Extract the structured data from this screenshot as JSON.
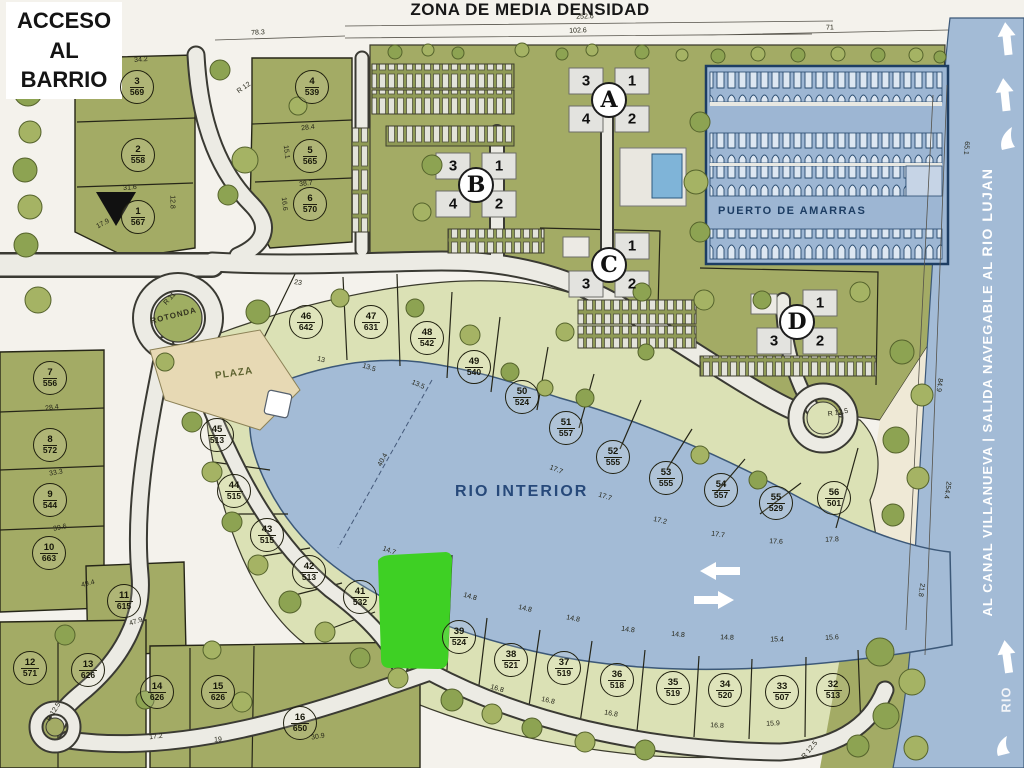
{
  "banner": "ZONA DE MEDIA DENSIDAD",
  "access_sign": {
    "l1": "ACCESO",
    "l2": "AL",
    "l3": "BARRIO"
  },
  "labels": {
    "rio_interior": "RIO INTERIOR",
    "puerto": "PUERTO DE AMARRAS",
    "plaza": "PLAZA",
    "rotonda": "ROTONDA",
    "canal_prefix": "AL CANAL VILLANUEVA  |  SALIDA NAVEGABLE AL ",
    "rio_lujan": "RIO LUJAN",
    "rio": "RIO"
  },
  "colors": {
    "paper": "#f4f2ec",
    "water": "#a3bbd6",
    "land": "#a3ab65",
    "lots": "#dbe1b5",
    "road": "#ecebe4",
    "marina": "#9db6d3",
    "highlight": "#3ed024",
    "navy": "#1d3d63"
  },
  "buildings": [
    {
      "letter": "A",
      "x": 609,
      "y": 100,
      "units": [
        {
          "n": "3",
          "dx": -23,
          "dy": -19
        },
        {
          "n": "1",
          "dx": 23,
          "dy": -19
        },
        {
          "n": "4",
          "dx": -23,
          "dy": 19
        },
        {
          "n": "2",
          "dx": 23,
          "dy": 19
        }
      ]
    },
    {
      "letter": "B",
      "x": 476,
      "y": 185,
      "units": [
        {
          "n": "3",
          "dx": -23,
          "dy": -19
        },
        {
          "n": "1",
          "dx": 23,
          "dy": -19
        },
        {
          "n": "4",
          "dx": -23,
          "dy": 19
        },
        {
          "n": "2",
          "dx": 23,
          "dy": 19
        }
      ]
    },
    {
      "letter": "C",
      "x": 609,
      "y": 265,
      "units": [
        {
          "n": "1",
          "dx": 23,
          "dy": -19
        },
        {
          "n": "2",
          "dx": 23,
          "dy": 19
        },
        {
          "n": "3",
          "dx": -23,
          "dy": 19
        }
      ]
    },
    {
      "letter": "D",
      "x": 797,
      "y": 322,
      "units": [
        {
          "n": "1",
          "dx": 23,
          "dy": -19
        },
        {
          "n": "2",
          "dx": 23,
          "dy": 19
        },
        {
          "n": "3",
          "dx": -23,
          "dy": 19
        }
      ]
    }
  ],
  "lots": [
    {
      "n": "1",
      "a": "567",
      "x": 138,
      "y": 217
    },
    {
      "n": "2",
      "a": "558",
      "x": 138,
      "y": 155
    },
    {
      "n": "3",
      "a": "569",
      "x": 137,
      "y": 87
    },
    {
      "n": "4",
      "a": "539",
      "x": 312,
      "y": 87
    },
    {
      "n": "5",
      "a": "565",
      "x": 310,
      "y": 156
    },
    {
      "n": "6",
      "a": "570",
      "x": 310,
      "y": 204
    },
    {
      "n": "7",
      "a": "556",
      "x": 50,
      "y": 378
    },
    {
      "n": "8",
      "a": "572",
      "x": 50,
      "y": 445
    },
    {
      "n": "9",
      "a": "544",
      "x": 50,
      "y": 500
    },
    {
      "n": "10",
      "a": "663",
      "x": 49,
      "y": 553
    },
    {
      "n": "11",
      "a": "615",
      "x": 124,
      "y": 601
    },
    {
      "n": "12",
      "a": "571",
      "x": 30,
      "y": 668
    },
    {
      "n": "13",
      "a": "626",
      "x": 88,
      "y": 670
    },
    {
      "n": "14",
      "a": "626",
      "x": 157,
      "y": 692
    },
    {
      "n": "15",
      "a": "626",
      "x": 218,
      "y": 692
    },
    {
      "n": "16",
      "a": "650",
      "x": 300,
      "y": 723
    },
    {
      "n": "32",
      "a": "513",
      "x": 833,
      "y": 690
    },
    {
      "n": "33",
      "a": "507",
      "x": 782,
      "y": 692
    },
    {
      "n": "34",
      "a": "520",
      "x": 725,
      "y": 690
    },
    {
      "n": "35",
      "a": "519",
      "x": 673,
      "y": 688
    },
    {
      "n": "36",
      "a": "518",
      "x": 617,
      "y": 680
    },
    {
      "n": "37",
      "a": "519",
      "x": 564,
      "y": 668
    },
    {
      "n": "38",
      "a": "521",
      "x": 511,
      "y": 660
    },
    {
      "n": "39",
      "a": "524",
      "x": 459,
      "y": 637
    },
    {
      "n": "41",
      "a": "532",
      "x": 360,
      "y": 597
    },
    {
      "n": "42",
      "a": "513",
      "x": 309,
      "y": 572
    },
    {
      "n": "43",
      "a": "515",
      "x": 267,
      "y": 535
    },
    {
      "n": "44",
      "a": "515",
      "x": 234,
      "y": 491
    },
    {
      "n": "45",
      "a": "513",
      "x": 217,
      "y": 435
    },
    {
      "n": "46",
      "a": "642",
      "x": 306,
      "y": 322
    },
    {
      "n": "47",
      "a": "631",
      "x": 371,
      "y": 322
    },
    {
      "n": "48",
      "a": "542",
      "x": 427,
      "y": 338
    },
    {
      "n": "49",
      "a": "540",
      "x": 474,
      "y": 367
    },
    {
      "n": "50",
      "a": "524",
      "x": 522,
      "y": 397
    },
    {
      "n": "51",
      "a": "557",
      "x": 566,
      "y": 428
    },
    {
      "n": "52",
      "a": "555",
      "x": 613,
      "y": 457
    },
    {
      "n": "53",
      "a": "555",
      "x": 666,
      "y": 478
    },
    {
      "n": "54",
      "a": "557",
      "x": 721,
      "y": 490
    },
    {
      "n": "55",
      "a": "529",
      "x": 776,
      "y": 503
    },
    {
      "n": "56",
      "a": "501",
      "x": 834,
      "y": 498
    }
  ],
  "dims": [
    {
      "t": "78.3",
      "x": 258,
      "y": 33,
      "r": -3
    },
    {
      "t": "252.6",
      "x": 585,
      "y": 17,
      "r": -2
    },
    {
      "t": "102.6",
      "x": 578,
      "y": 31,
      "r": -2
    },
    {
      "t": "71",
      "x": 830,
      "y": 28,
      "r": -2
    },
    {
      "t": "34.2",
      "x": 141,
      "y": 60,
      "r": -4
    },
    {
      "t": "31.6",
      "x": 130,
      "y": 188,
      "r": -4
    },
    {
      "t": "17.9",
      "x": 103,
      "y": 224,
      "r": -28
    },
    {
      "t": "12.8",
      "x": 172,
      "y": 202,
      "r": 90
    },
    {
      "t": "28.4",
      "x": 308,
      "y": 128,
      "r": -6
    },
    {
      "t": "38.7",
      "x": 306,
      "y": 184,
      "r": -6
    },
    {
      "t": "15.1",
      "x": 286,
      "y": 152,
      "r": 84
    },
    {
      "t": "16.6",
      "x": 284,
      "y": 204,
      "r": 84
    },
    {
      "t": "R 12",
      "x": 244,
      "y": 88,
      "r": -35
    },
    {
      "t": "R 11",
      "x": 170,
      "y": 299,
      "r": -48
    },
    {
      "t": "28.4",
      "x": 52,
      "y": 408,
      "r": -8
    },
    {
      "t": "33.3",
      "x": 56,
      "y": 473,
      "r": -10
    },
    {
      "t": "39.6",
      "x": 60,
      "y": 528,
      "r": -12
    },
    {
      "t": "49.4",
      "x": 88,
      "y": 584,
      "r": -14
    },
    {
      "t": "47.9",
      "x": 136,
      "y": 622,
      "r": -18
    },
    {
      "t": "R 12.5",
      "x": 54,
      "y": 712,
      "r": -58
    },
    {
      "t": "17.2",
      "x": 156,
      "y": 737,
      "r": -6
    },
    {
      "t": "19",
      "x": 218,
      "y": 740,
      "r": -4
    },
    {
      "t": "30.9",
      "x": 318,
      "y": 737,
      "r": -10
    },
    {
      "t": "23",
      "x": 298,
      "y": 283,
      "r": 8
    },
    {
      "t": "13",
      "x": 321,
      "y": 360,
      "r": 14
    },
    {
      "t": "13.5",
      "x": 369,
      "y": 368,
      "r": 18
    },
    {
      "t": "13.5",
      "x": 418,
      "y": 385,
      "r": 24
    },
    {
      "t": "40.4",
      "x": 383,
      "y": 460,
      "r": -62
    },
    {
      "t": "17.7",
      "x": 556,
      "y": 470,
      "r": 22
    },
    {
      "t": "17.7",
      "x": 605,
      "y": 497,
      "r": 18
    },
    {
      "t": "17.2",
      "x": 660,
      "y": 521,
      "r": 13
    },
    {
      "t": "17.7",
      "x": 718,
      "y": 535,
      "r": 8
    },
    {
      "t": "17.6",
      "x": 776,
      "y": 542,
      "r": 3
    },
    {
      "t": "17.8",
      "x": 832,
      "y": 540,
      "r": -2
    },
    {
      "t": "14.7",
      "x": 389,
      "y": 551,
      "r": 20
    },
    {
      "t": "14.8",
      "x": 470,
      "y": 597,
      "r": 16
    },
    {
      "t": "14.8",
      "x": 525,
      "y": 609,
      "r": 13
    },
    {
      "t": "14.8",
      "x": 573,
      "y": 619,
      "r": 11
    },
    {
      "t": "14.8",
      "x": 628,
      "y": 630,
      "r": 8
    },
    {
      "t": "14.8",
      "x": 678,
      "y": 635,
      "r": 5
    },
    {
      "t": "14.8",
      "x": 727,
      "y": 638,
      "r": 2
    },
    {
      "t": "15.4",
      "x": 777,
      "y": 640,
      "r": 0
    },
    {
      "t": "15.6",
      "x": 832,
      "y": 638,
      "r": -3
    },
    {
      "t": "16.8",
      "x": 497,
      "y": 689,
      "r": 16
    },
    {
      "t": "16.8",
      "x": 548,
      "y": 701,
      "r": 13
    },
    {
      "t": "16.8",
      "x": 611,
      "y": 714,
      "r": 10
    },
    {
      "t": "16.8",
      "x": 717,
      "y": 726,
      "r": 3
    },
    {
      "t": "15.9",
      "x": 773,
      "y": 724,
      "r": -2
    },
    {
      "t": "R 12.5",
      "x": 810,
      "y": 750,
      "r": -50
    },
    {
      "t": "R 12.5",
      "x": 838,
      "y": 413,
      "r": -10
    },
    {
      "t": "84.9",
      "x": 939,
      "y": 385,
      "r": 97
    },
    {
      "t": "254.4",
      "x": 947,
      "y": 490,
      "r": 98
    },
    {
      "t": "21.8",
      "x": 921,
      "y": 590,
      "r": 98
    },
    {
      "t": "65.1",
      "x": 966,
      "y": 148,
      "r": 95
    }
  ]
}
